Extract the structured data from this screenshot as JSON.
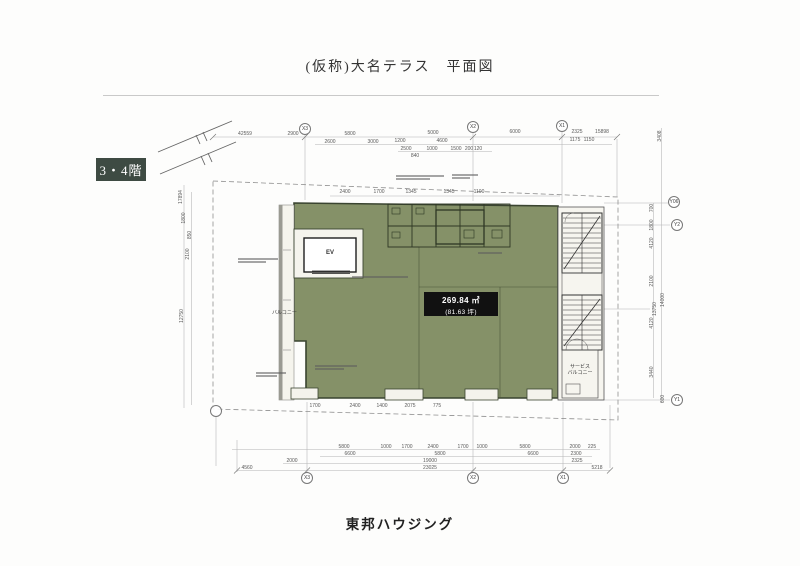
{
  "page": {
    "title": "(仮称)大名テラス　平面図",
    "floor_badge": "3・4階",
    "footer": "東邦ハウジング"
  },
  "plan": {
    "area_label": {
      "line1": "269.84 ㎡",
      "line2": "(81.63 坪)"
    },
    "labels": {
      "elevator": "EV",
      "balcony": "バルコニー",
      "service_balcony_line1": "サービス",
      "service_balcony_line2": "バルコニー"
    },
    "colors": {
      "floor_fill": "#859168",
      "wall_line": "#3a4430",
      "badge_bg": "#3e4b43",
      "area_box_bg": "#111111"
    },
    "grid_bubbles": [
      {
        "t": "X3",
        "x": 305,
        "y": 129
      },
      {
        "t": "X2",
        "x": 473,
        "y": 127
      },
      {
        "t": "X1",
        "x": 562,
        "y": 126
      },
      {
        "t": "X3",
        "x": 307,
        "y": 478
      },
      {
        "t": "X2",
        "x": 473,
        "y": 478
      },
      {
        "t": "X1",
        "x": 563,
        "y": 478
      },
      {
        "t": "Y06",
        "x": 674,
        "y": 202
      },
      {
        "t": "Y2",
        "x": 677,
        "y": 225
      },
      {
        "t": "Y1",
        "x": 677,
        "y": 400
      },
      {
        "t": "",
        "x": 216,
        "y": 411
      }
    ],
    "dims": [
      {
        "t": "42559",
        "x": 245,
        "y": 134
      },
      {
        "t": "2900",
        "x": 293,
        "y": 134
      },
      {
        "t": "5800",
        "x": 350,
        "y": 134
      },
      {
        "t": "5000",
        "x": 433,
        "y": 133
      },
      {
        "t": "6000",
        "x": 515,
        "y": 132
      },
      {
        "t": "2325",
        "x": 577,
        "y": 132
      },
      {
        "t": "15898",
        "x": 602,
        "y": 132
      },
      {
        "t": "2600",
        "x": 330,
        "y": 142
      },
      {
        "t": "3000",
        "x": 373,
        "y": 142
      },
      {
        "t": "1200",
        "x": 400,
        "y": 141
      },
      {
        "t": "4600",
        "x": 442,
        "y": 141
      },
      {
        "t": "1175",
        "x": 575,
        "y": 140
      },
      {
        "t": "1150",
        "x": 589,
        "y": 140
      },
      {
        "t": "2500",
        "x": 406,
        "y": 149
      },
      {
        "t": "1000",
        "x": 432,
        "y": 149
      },
      {
        "t": "1500",
        "x": 456,
        "y": 149
      },
      {
        "t": "200",
        "x": 469,
        "y": 149
      },
      {
        "t": "120",
        "x": 478,
        "y": 149
      },
      {
        "t": "840",
        "x": 415,
        "y": 156
      },
      {
        "t": "2400",
        "x": 345,
        "y": 192
      },
      {
        "t": "1700",
        "x": 379,
        "y": 192
      },
      {
        "t": "1345",
        "x": 411,
        "y": 192
      },
      {
        "t": "1345",
        "x": 449,
        "y": 192
      },
      {
        "t": "1100",
        "x": 479,
        "y": 192
      },
      {
        "t": "17894",
        "x": 181,
        "y": 197,
        "r": 1
      },
      {
        "t": "1800",
        "x": 184,
        "y": 218,
        "r": 1
      },
      {
        "t": "850",
        "x": 190,
        "y": 235,
        "r": 1
      },
      {
        "t": "2100",
        "x": 188,
        "y": 254,
        "r": 1
      },
      {
        "t": "12750",
        "x": 182,
        "y": 316,
        "r": 1
      },
      {
        "t": "3408",
        "x": 660,
        "y": 136,
        "r": 1
      },
      {
        "t": "700",
        "x": 652,
        "y": 208,
        "r": 1
      },
      {
        "t": "1800",
        "x": 652,
        "y": 225,
        "r": 1
      },
      {
        "t": "4120",
        "x": 652,
        "y": 243,
        "r": 1
      },
      {
        "t": "2100",
        "x": 652,
        "y": 281,
        "r": 1
      },
      {
        "t": "13750",
        "x": 655,
        "y": 309,
        "r": 1
      },
      {
        "t": "14000",
        "x": 663,
        "y": 300,
        "r": 1
      },
      {
        "t": "4120",
        "x": 652,
        "y": 323,
        "r": 1
      },
      {
        "t": "3440",
        "x": 652,
        "y": 372,
        "r": 1
      },
      {
        "t": "600",
        "x": 663,
        "y": 399,
        "r": 1
      },
      {
        "t": "1700",
        "x": 315,
        "y": 406
      },
      {
        "t": "2400",
        "x": 355,
        "y": 406
      },
      {
        "t": "1400",
        "x": 382,
        "y": 406
      },
      {
        "t": "2075",
        "x": 410,
        "y": 406
      },
      {
        "t": "775",
        "x": 437,
        "y": 406
      },
      {
        "t": "5800",
        "x": 344,
        "y": 447
      },
      {
        "t": "1000",
        "x": 386,
        "y": 447
      },
      {
        "t": "1700",
        "x": 407,
        "y": 447
      },
      {
        "t": "2400",
        "x": 433,
        "y": 447
      },
      {
        "t": "1700",
        "x": 463,
        "y": 447
      },
      {
        "t": "1000",
        "x": 482,
        "y": 447
      },
      {
        "t": "5800",
        "x": 525,
        "y": 447
      },
      {
        "t": "2000",
        "x": 575,
        "y": 447
      },
      {
        "t": "225",
        "x": 592,
        "y": 447
      },
      {
        "t": "6600",
        "x": 350,
        "y": 454
      },
      {
        "t": "5800",
        "x": 440,
        "y": 454
      },
      {
        "t": "6600",
        "x": 533,
        "y": 454
      },
      {
        "t": "2300",
        "x": 576,
        "y": 454
      },
      {
        "t": "2000",
        "x": 292,
        "y": 461
      },
      {
        "t": "19000",
        "x": 430,
        "y": 461
      },
      {
        "t": "2325",
        "x": 577,
        "y": 461
      },
      {
        "t": "4560",
        "x": 247,
        "y": 468
      },
      {
        "t": "23025",
        "x": 430,
        "y": 468
      },
      {
        "t": "5218",
        "x": 597,
        "y": 468
      }
    ],
    "annotations": [
      {
        "x": 238,
        "y": 258,
        "w": 40,
        "n": 2
      },
      {
        "x": 396,
        "y": 175,
        "w": 48,
        "n": 2
      },
      {
        "x": 452,
        "y": 174,
        "w": 26,
        "n": 2
      },
      {
        "x": 352,
        "y": 276,
        "w": 80,
        "n": 1
      },
      {
        "x": 315,
        "y": 365,
        "w": 42,
        "n": 2
      },
      {
        "x": 256,
        "y": 372,
        "w": 30,
        "n": 2
      },
      {
        "x": 478,
        "y": 252,
        "w": 34,
        "n": 1
      }
    ]
  }
}
